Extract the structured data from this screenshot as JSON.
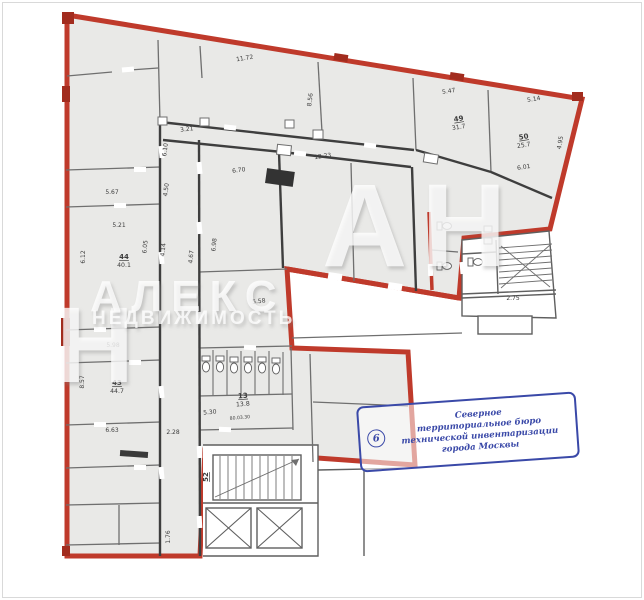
{
  "document": {
    "kind": "floor-plan"
  },
  "stamp": {
    "number": "6",
    "lines": [
      "Северное",
      "территориальное бюро",
      "технической инвентаризации",
      "города Москвы"
    ]
  },
  "watermark": {
    "big_letter": "Н",
    "brand": "АЛЕКС",
    "brand2": "НЕДВИЖИМОСТЬ",
    "initials": "АН"
  },
  "colors": {
    "premises_red": "#bf3a2b",
    "fill_gray": "#e9e9e7",
    "wall_gray": "#6f6f6f",
    "wall_dark": "#3e3e3e",
    "stamp_blue": "#3a49a8",
    "text": "#3c3c3c"
  },
  "plan": {
    "labels": [
      {
        "text": "11.72",
        "x": 245,
        "y": 60,
        "r": -9,
        "cls": "dim"
      },
      {
        "text": "5.47",
        "x": 449,
        "y": 93,
        "r": -9,
        "cls": "dim"
      },
      {
        "text": "5.14",
        "x": 534,
        "y": 101,
        "r": -9,
        "cls": "dim"
      },
      {
        "text": "8.56",
        "x": 312,
        "y": 100,
        "r": -83,
        "cls": "dim"
      },
      {
        "text": "6.01",
        "x": 524,
        "y": 169,
        "r": -9,
        "cls": "dim"
      },
      {
        "text": "4.95",
        "x": 562,
        "y": 143,
        "r": -80,
        "cls": "dim"
      },
      {
        "text": "3.21",
        "x": 187,
        "y": 131,
        "r": -7,
        "cls": "dim"
      },
      {
        "text": "12.23",
        "x": 323,
        "y": 158,
        "r": -8,
        "cls": "dim"
      },
      {
        "text": "6.70",
        "x": 239,
        "y": 172,
        "r": -7,
        "cls": "dim"
      },
      {
        "text": "6.10",
        "x": 167,
        "y": 150,
        "r": -83,
        "cls": "dim"
      },
      {
        "text": "4.50",
        "x": 168,
        "y": 190,
        "r": -83,
        "cls": "dim"
      },
      {
        "text": "5.67",
        "x": 112,
        "y": 194,
        "r": 0,
        "cls": "dim"
      },
      {
        "text": "5.21",
        "x": 119,
        "y": 227,
        "r": 0,
        "cls": "dim"
      },
      {
        "text": "6.12",
        "x": 85,
        "y": 257,
        "r": -90,
        "cls": "dim"
      },
      {
        "text": "6.05",
        "x": 147,
        "y": 247,
        "r": -85,
        "cls": "dim"
      },
      {
        "text": "4.14",
        "x": 165,
        "y": 250,
        "r": -85,
        "cls": "dim"
      },
      {
        "text": "4.67",
        "x": 193,
        "y": 257,
        "r": -85,
        "cls": "dim"
      },
      {
        "text": "6.98",
        "x": 216,
        "y": 245,
        "r": -85,
        "cls": "dim"
      },
      {
        "text": "5.58",
        "x": 259,
        "y": 303,
        "r": -5,
        "cls": "dim"
      },
      {
        "text": "5.98",
        "x": 113,
        "y": 347,
        "r": 0,
        "cls": "dim"
      },
      {
        "text": "8.57",
        "x": 84,
        "y": 382,
        "r": -90,
        "cls": "dim"
      },
      {
        "text": "6.63",
        "x": 112,
        "y": 432,
        "r": 0,
        "cls": "dim"
      },
      {
        "text": "2.28",
        "x": 173,
        "y": 434,
        "r": 0,
        "cls": "dim"
      },
      {
        "text": "5.30",
        "x": 210,
        "y": 414,
        "r": -5,
        "cls": "dim"
      },
      {
        "text": "2.75",
        "x": 513,
        "y": 300,
        "r": 0,
        "cls": "dim"
      },
      {
        "text": "1.76",
        "x": 170,
        "y": 537,
        "r": -90,
        "cls": "dim"
      },
      {
        "text": "80.03.30",
        "x": 240,
        "y": 419,
        "r": -5,
        "cls": "tiny"
      },
      {
        "text": "44",
        "x": 124,
        "y": 259,
        "r": 0,
        "cls": "room",
        "u": true
      },
      {
        "text": "40.1",
        "x": 124,
        "y": 267,
        "r": 0,
        "cls": "area"
      },
      {
        "text": "43",
        "x": 117,
        "y": 385,
        "r": 0,
        "cls": "room",
        "u": true
      },
      {
        "text": "44.7",
        "x": 117,
        "y": 393,
        "r": 0,
        "cls": "area"
      },
      {
        "text": "13",
        "x": 243,
        "y": 398,
        "r": -4,
        "cls": "room",
        "u": true
      },
      {
        "text": "13.8",
        "x": 243,
        "y": 406,
        "r": -4,
        "cls": "area"
      },
      {
        "text": "49",
        "x": 459,
        "y": 121,
        "r": -9,
        "cls": "room",
        "u": true
      },
      {
        "text": "31.7",
        "x": 459,
        "y": 129,
        "r": -9,
        "cls": "area"
      },
      {
        "text": "50",
        "x": 524,
        "y": 139,
        "r": -9,
        "cls": "room",
        "u": true
      },
      {
        "text": "25.7",
        "x": 524,
        "y": 147,
        "r": -9,
        "cls": "area"
      },
      {
        "text": "52",
        "x": 208,
        "y": 477,
        "r": -90,
        "cls": "room",
        "u": true
      }
    ]
  }
}
